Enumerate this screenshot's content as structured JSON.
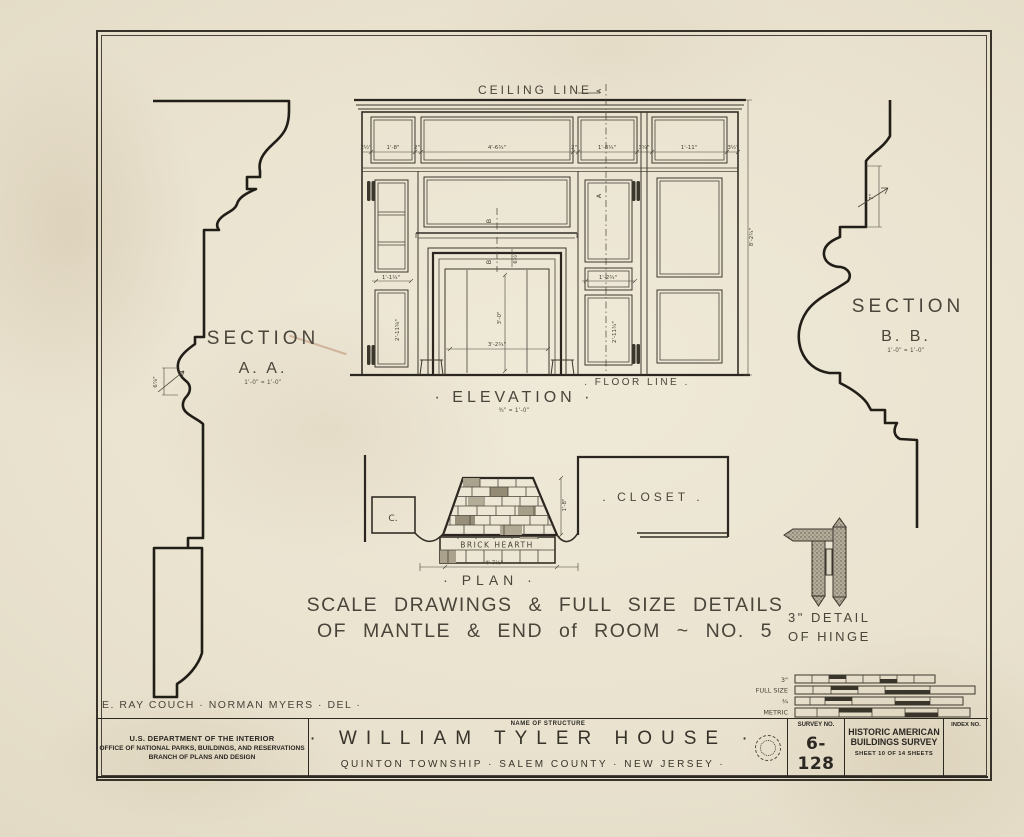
{
  "sheet": {
    "labels": {
      "ceiling_line": "CEILING LINE",
      "floor_line": ". FLOOR  LINE .",
      "elevation_title": "· ELEVATION ·",
      "elevation_scale": "¾\" = 1'-0\"",
      "plan_title": "· PLAN ·",
      "caption_line1": "SCALE  DRAWINGS  &  FULL  SIZE  DETAILS",
      "caption_line2": "OF  MANTLE  &  END  of  ROOM  ~  NO. 5",
      "credits": "E. RAY COUCH  ·  NORMAN MYERS  · DEL ·"
    },
    "section_aa": {
      "title": "SECTION",
      "letters": "A. A.",
      "scale": "1'-0\" = 1'-0\"",
      "dim": "6⅞\""
    },
    "section_bb": {
      "title": "SECTION",
      "letters": "B. B.",
      "scale": "1'-0\" = 1'-0\"",
      "dim": "7\""
    },
    "elevation": {
      "frieze_dims": [
        "2½\"",
        "1'-8\"",
        "2\"",
        "4'-6¾\"",
        "2\"",
        "1'-8¾\"",
        "3¾\"",
        "1'-11\"",
        "3½\""
      ],
      "left_door_w": "1'-1¾\"",
      "left_door_h": "2'-11⅝\"",
      "right_door_w": "1'-2¾\"",
      "right_door_h": "2'-11¾\"",
      "opening_w": "3'-2¾\"",
      "opening_h": "3'-0\"",
      "shelf_gap": "6½\"",
      "overall_h": "8'-2¾\"",
      "marker_a": "A",
      "marker_b": "B"
    },
    "plan": {
      "hearth": "BRICK HEARTH",
      "closet": ". CLOSET .",
      "c": "C.",
      "width": "4'-7½\"",
      "depth": "1'-8\""
    },
    "hinge": {
      "line1": "3\" DETAIL",
      "line2": "OF HINGE"
    },
    "scalebars": {
      "row1": "3\"",
      "row2": "FULL SIZE",
      "row3": "¾",
      "row4": "METRIC"
    },
    "title_block": {
      "agency1": "U.S. DEPARTMENT OF THE INTERIOR",
      "agency2": "OFFICE OF NATIONAL PARKS, BUILDINGS, AND RESERVATIONS",
      "agency3": "BRANCH OF PLANS AND DESIGN",
      "name_label": "NAME OF STRUCTURE",
      "structure": "· WILLIAM  TYLER  HOUSE ·",
      "location": "QUINTON  TOWNSHIP  ·  SALEM  COUNTY  ·  NEW  JERSEY ·",
      "survey_label": "SURVEY NO.",
      "survey_no": "6-128",
      "org1": "HISTORIC AMERICAN",
      "org2": "BUILDINGS SURVEY",
      "sheet_info": "SHEET 10 OF 14 SHEETS",
      "index_label": "INDEX NO."
    }
  }
}
